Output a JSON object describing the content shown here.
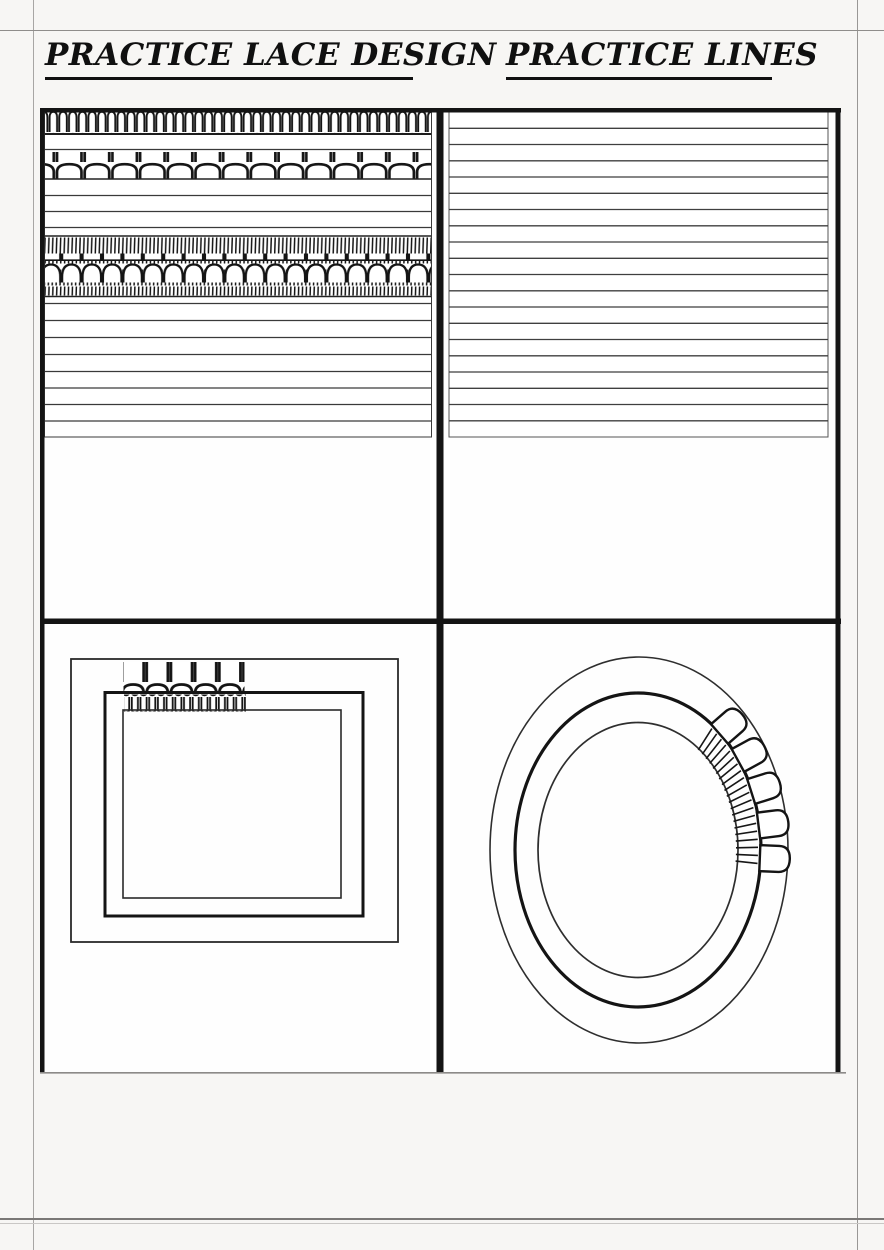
{
  "header": {
    "left_title": "PRACTICE LACE DESIGN",
    "right_title": "PRACTICE LINES"
  },
  "colors": {
    "ink": "#141414",
    "rule_line": "#3a3a3a",
    "paper": "#ffffff",
    "page_background": "#f7f6f4",
    "registration_line": "#a8a6a4"
  },
  "icons": {
    "small_arch_band": "row of small packed lace arches",
    "large_scallop_band": "row of large piped scallops",
    "dense_lace_band": "hatch-dome-hatch lace band",
    "fringe_band": "hanging loop fringe",
    "shell_petals": "piped shell petals on oval",
    "radial_hatch": "radial stitch hatching on oval"
  }
}
